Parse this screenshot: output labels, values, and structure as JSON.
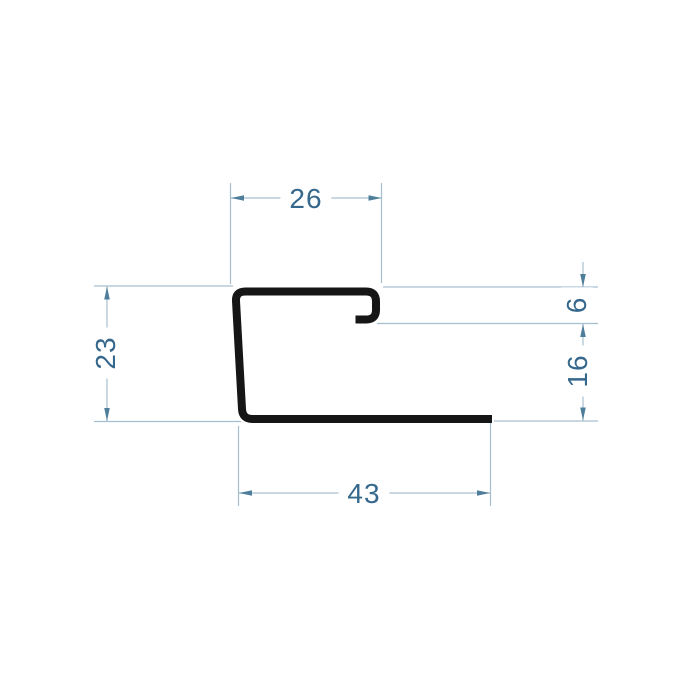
{
  "drawing": {
    "type": "technical-profile-cross-section",
    "dimensions": {
      "top_width": "26",
      "left_height": "23",
      "lip_depth": "6",
      "right_height": "16",
      "bottom_width": "43"
    },
    "colors": {
      "profile": "#161616",
      "dimension_line": "#a6bfcf",
      "arrow": "#4f7e9b",
      "label_text": "#35688c",
      "background": "#ffffff"
    }
  }
}
